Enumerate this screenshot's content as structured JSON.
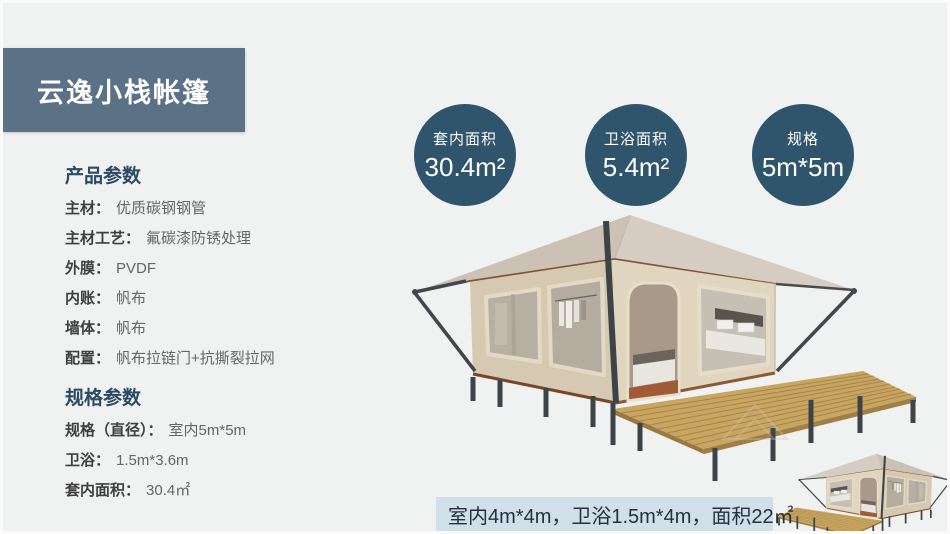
{
  "banner": {
    "title": "云逸小栈帐篷"
  },
  "colors": {
    "page_bg": "#f0f1f1",
    "banner_bg": "#5b7186",
    "circle_bg": "#2f556d",
    "heading_text": "#2c4a63",
    "caption_bg": "#cfe0e8",
    "tent_wall": "#d5c9b2",
    "tent_roof": "#d0c7bb",
    "deck_wood": "#c9a660",
    "frame_metal": "#42474c",
    "trim_brown": "#7a4527"
  },
  "stat_circles": [
    {
      "label": "套内面积",
      "value": "30.4m²"
    },
    {
      "label": "卫浴面积",
      "value": "5.4m²"
    },
    {
      "label": "规格",
      "value": "5m*5m"
    }
  ],
  "spec_panel": {
    "sections": [
      {
        "heading": "产品参数",
        "rows": [
          {
            "label": "主材：",
            "value": "优质碳钢钢管"
          },
          {
            "label": "主材工艺：",
            "value": "氟碳漆防锈处理"
          },
          {
            "label": "外膜：",
            "value": "PVDF"
          },
          {
            "label": "内账：",
            "value": "帆布"
          },
          {
            "label": "墙体：",
            "value": "帆布"
          },
          {
            "label": "配置：",
            "value": "帆布拉链门+抗撕裂拉网"
          }
        ]
      },
      {
        "heading": "规格参数",
        "rows": [
          {
            "label": "规格（直径）：",
            "value": "室内5m*5m"
          },
          {
            "label": "卫浴：",
            "value": "1.5m*3.6m"
          },
          {
            "label": "套内面积：",
            "value": "30.4㎡"
          }
        ]
      }
    ]
  },
  "caption_bar": {
    "text": "室内4m*4m，卫浴1.5m*4m，面积22㎡"
  }
}
